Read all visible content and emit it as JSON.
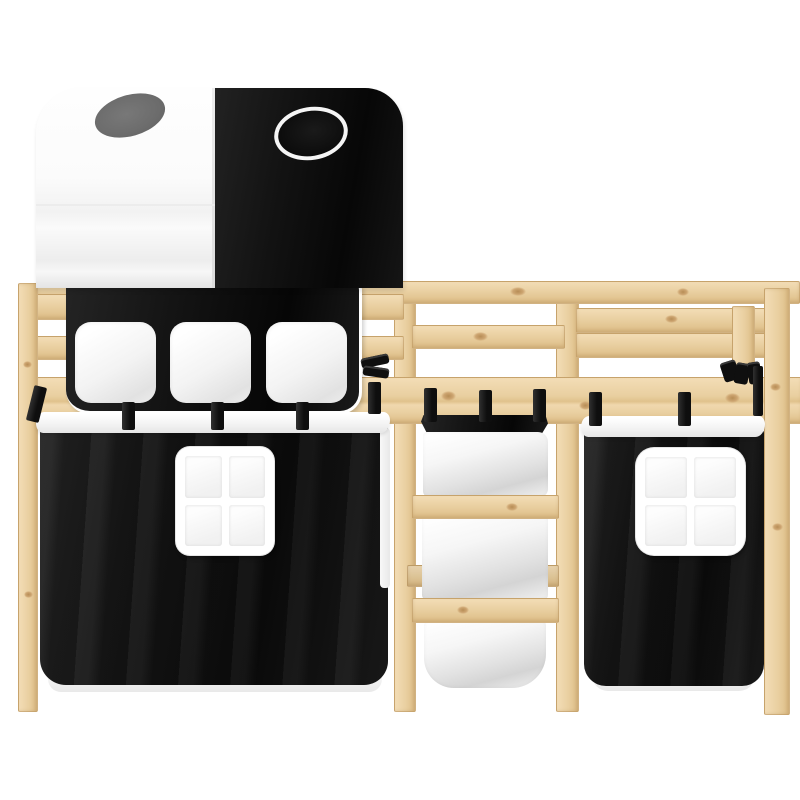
{
  "meta": {
    "type": "product-photo",
    "subject": "Kids loft bed in pine wood with play tunnel, ladder and black-white curtains",
    "background": "plain white studio background",
    "text_on_image": ""
  },
  "palette": {
    "background": "#ffffff",
    "wood_light": "#f3ddb6",
    "wood_mid": "#e9cfa0",
    "wood_dark": "#ddbd86",
    "wood_edge": "#c9a368",
    "wood_knot": "#b78d56",
    "fabric_black": "#141414",
    "fabric_white": "#f1f1f1",
    "fabric_white_shadow": "#d9d9d9",
    "tunnel_hole_gray": "#6c6c6c",
    "ring_outline_white": "#f5f5f5"
  },
  "parts": {
    "frame": "pine wood loft bed frame with guardrails and four posts",
    "tunnel": "half white, half black play tunnel on top of the bed",
    "tunnel_hole": "gray oval opening on white tunnel half",
    "tunnel_ring": "white circle outline window on black tunnel half",
    "organizer": "black hanging organizer with three white pockets",
    "left_curtain": "black under-bed curtain with white trim and white four-pane window",
    "right_curtain": "black under-bed curtain with white trim and white four-pane window",
    "ladder": "wooden ladder with three rungs",
    "ladder_bag": "white fabric hanging pockets woven through the ladder",
    "straps": "black fastening straps over the bed rail",
    "windows": "white square windows with four panes"
  }
}
